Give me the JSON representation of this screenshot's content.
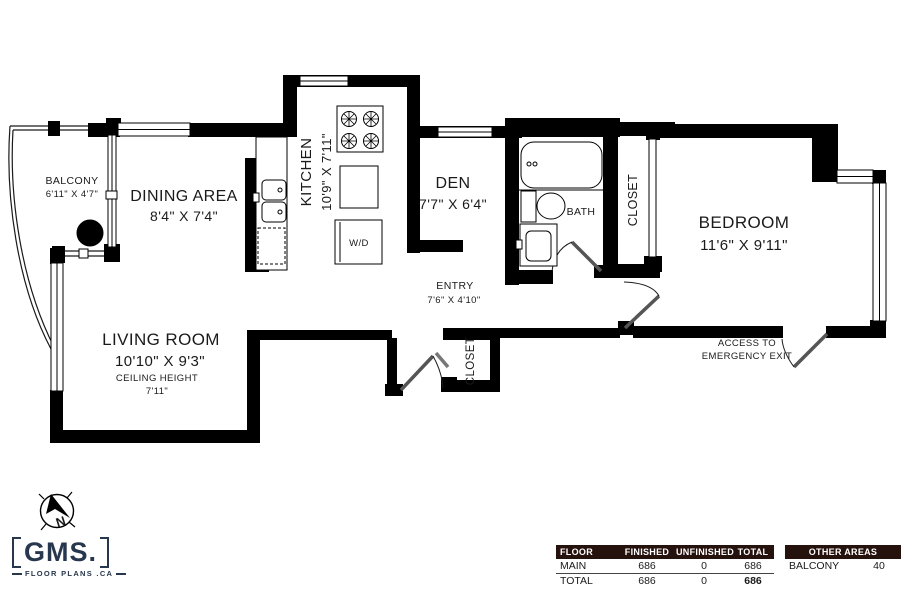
{
  "colors": {
    "wall": "#000000",
    "text": "#1a1a1a",
    "logo_navy": "#27374d",
    "table_header_bg": "#26120d",
    "door_leaf": "#555555"
  },
  "rooms": {
    "balcony": {
      "name": "BALCONY",
      "dims": "6'11\" X 4'7\""
    },
    "dining": {
      "name": "DINING AREA",
      "dims": "8'4\" X 7'4\""
    },
    "kitchen": {
      "name": "KITCHEN",
      "dims": "10'9\" X 7'11\""
    },
    "den": {
      "name": "DEN",
      "dims": "7'7\" X 6'4\""
    },
    "bath": {
      "name": "BATH"
    },
    "bath_closet": {
      "name": "CLOSET"
    },
    "bedroom": {
      "name": "BEDROOM",
      "dims": "11'6\" X 9'11\""
    },
    "entry": {
      "name": "ENTRY",
      "dims": "7'6\" X 4'10\""
    },
    "entry_closet": {
      "name": "CLOSET"
    },
    "living_room": {
      "name": "LIVING ROOM",
      "dims": "10'10\" X 9'3\"",
      "ceiling_label": "CEILING HEIGHT",
      "ceiling_value": "7'11\""
    },
    "laundry": {
      "name": "W/D"
    }
  },
  "annotations": {
    "emergency_line1": "ACCESS TO",
    "emergency_line2": "EMERGENCY EXIT"
  },
  "compass": {
    "north": "N"
  },
  "logo": {
    "name": "GMS.",
    "tagline": "FLOOR PLANS .CA"
  },
  "area_table": {
    "col_floor": "FLOOR",
    "col_finished": "FINISHED",
    "col_unfinished": "UNFINISHED",
    "col_total": "TOTAL",
    "rows": [
      [
        "MAIN",
        "686",
        "0",
        "686"
      ],
      [
        "TOTAL",
        "686",
        "0",
        "686"
      ]
    ],
    "other_header": "OTHER AREAS",
    "other_rows": [
      [
        "BALCONY",
        "40"
      ]
    ]
  }
}
